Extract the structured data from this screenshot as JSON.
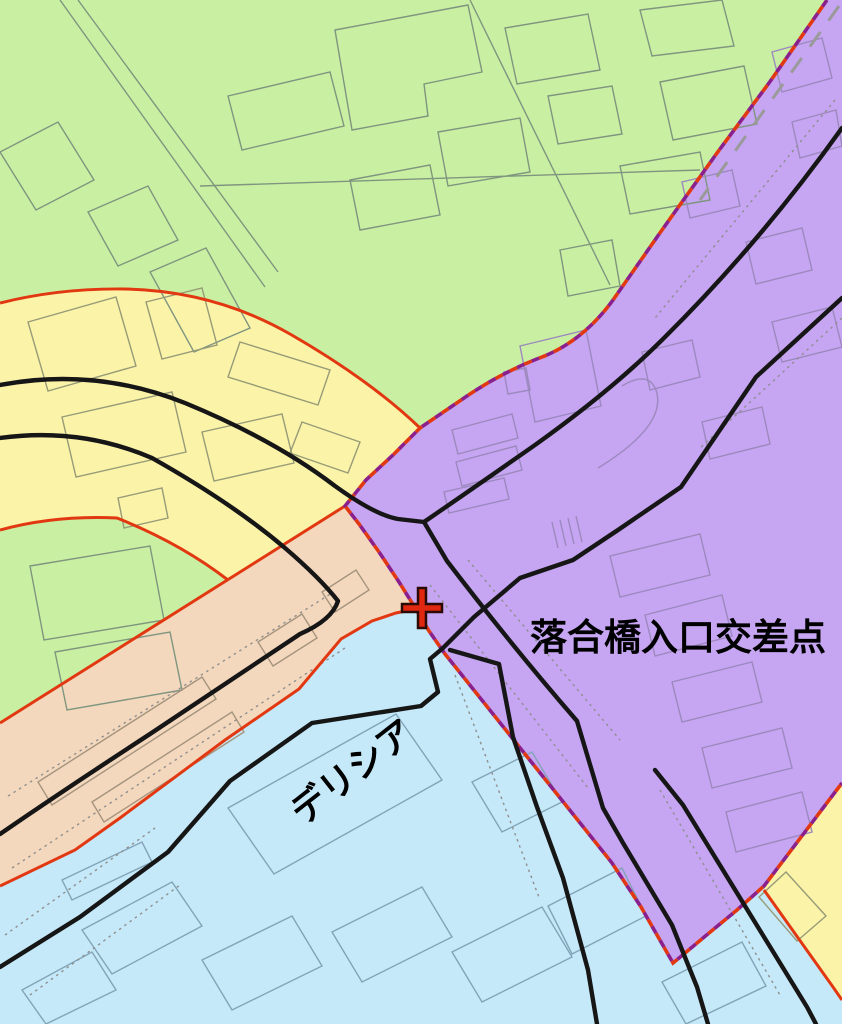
{
  "map": {
    "labels": {
      "intersection": "落合橋入口交差点",
      "store": "デリシア"
    },
    "marker": {
      "type": "cross",
      "x": 422,
      "y": 608
    },
    "colors": {
      "green": "#c9f0a2",
      "yellow": "#fbf3a8",
      "purple": "#c6a5f2",
      "peach": "#f4d8bd",
      "lightblue": "#c5e9f8",
      "red": "#e23812",
      "boundary_purple": "#8b1f8b",
      "boundary_red": "#e23812",
      "road": "#161616",
      "road_edge": "#8f8f8f",
      "rail_dash": "#9a9a9a",
      "outline_green": "#7f957f",
      "outline_purple": "#9c89bd",
      "outline_blue": "#83a3b8",
      "outline_peach": "#a5947e",
      "outline_yellow": "#979b77",
      "cross_red": "#e02810",
      "cross_outline": "#2a0a05",
      "label": "#000000"
    }
  }
}
